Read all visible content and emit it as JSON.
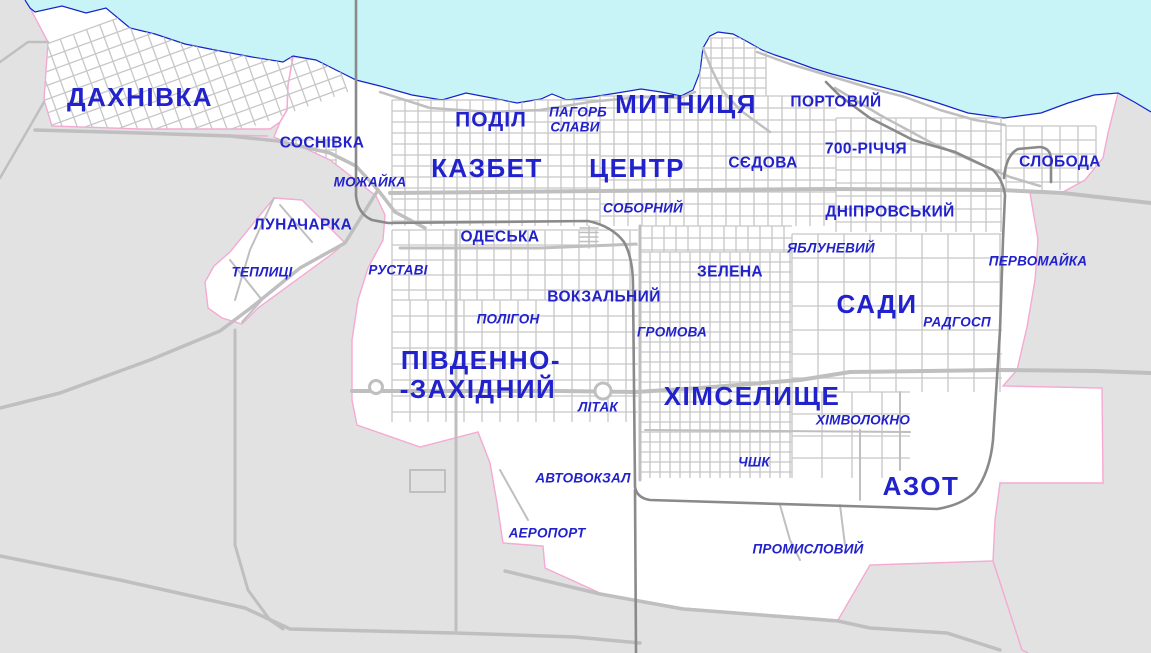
{
  "map": {
    "description": "City district map",
    "labels": [
      {
        "text": "ДАХНІВКА",
        "x": 140,
        "y": 97,
        "style": "xl"
      },
      {
        "text": "МИТНИЦЯ",
        "x": 686,
        "y": 104,
        "style": "xl"
      },
      {
        "text": "КАЗБЕТ",
        "x": 487,
        "y": 168,
        "style": "xl"
      },
      {
        "text": "ЦЕНТР",
        "x": 637,
        "y": 168,
        "style": "xl"
      },
      {
        "text": "ПІВДЕННО-",
        "x": 481,
        "y": 360,
        "style": "xl"
      },
      {
        "text": "-ЗАХІДНИЙ",
        "x": 478,
        "y": 389,
        "style": "xl"
      },
      {
        "text": "ХІМСЕЛИЩЕ",
        "x": 752,
        "y": 396,
        "style": "xl"
      },
      {
        "text": "САДИ",
        "x": 877,
        "y": 304,
        "style": "xl"
      },
      {
        "text": "АЗОТ",
        "x": 921,
        "y": 486,
        "style": "xl"
      },
      {
        "text": "ПОДІЛ",
        "x": 491,
        "y": 120,
        "style": "lg"
      },
      {
        "text": "СОСНІВКА",
        "x": 322,
        "y": 143,
        "style": "md"
      },
      {
        "text": "ЛУНАЧАРКА",
        "x": 303,
        "y": 225,
        "style": "md"
      },
      {
        "text": "ОДЕСЬКА",
        "x": 500,
        "y": 237,
        "style": "md"
      },
      {
        "text": "ВОКЗАЛЬНИЙ",
        "x": 604,
        "y": 297,
        "style": "md"
      },
      {
        "text": "ЗЕЛЕНА",
        "x": 730,
        "y": 272,
        "style": "md"
      },
      {
        "text": "СЄДОВА",
        "x": 763,
        "y": 163,
        "style": "md"
      },
      {
        "text": "ПОРТОВИЙ",
        "x": 836,
        "y": 102,
        "style": "md"
      },
      {
        "text": "700-РІЧЧЯ",
        "x": 866,
        "y": 149,
        "style": "md"
      },
      {
        "text": "ДНІПРОВСЬКИЙ",
        "x": 890,
        "y": 212,
        "style": "md"
      },
      {
        "text": "СЛОБОДА",
        "x": 1060,
        "y": 162,
        "style": "md"
      },
      {
        "text": "МОЖАЙКА",
        "x": 370,
        "y": 182,
        "style": "it"
      },
      {
        "text": "ПАГОРБ",
        "x": 578,
        "y": 112,
        "style": "it"
      },
      {
        "text": "СЛАВИ",
        "x": 575,
        "y": 127,
        "style": "it"
      },
      {
        "text": "СОБОРНИЙ",
        "x": 643,
        "y": 208,
        "style": "it"
      },
      {
        "text": "ЯБЛУНЕВИЙ",
        "x": 831,
        "y": 248,
        "style": "it"
      },
      {
        "text": "ПЕРВОМАЙКА",
        "x": 1038,
        "y": 261,
        "style": "it"
      },
      {
        "text": "ТЕПЛИЦІ",
        "x": 262,
        "y": 272,
        "style": "it"
      },
      {
        "text": "РУСТАВІ",
        "x": 398,
        "y": 270,
        "style": "it"
      },
      {
        "text": "ПОЛІГОН",
        "x": 508,
        "y": 319,
        "style": "it"
      },
      {
        "text": "ГРОМОВА",
        "x": 672,
        "y": 332,
        "style": "it"
      },
      {
        "text": "РАДГОСП",
        "x": 957,
        "y": 322,
        "style": "it"
      },
      {
        "text": "ХІМВОЛОКНО",
        "x": 863,
        "y": 420,
        "style": "it"
      },
      {
        "text": "ЛІТАК",
        "x": 598,
        "y": 407,
        "style": "it"
      },
      {
        "text": "ЧШК",
        "x": 754,
        "y": 462,
        "style": "it"
      },
      {
        "text": "АВТОВОКЗАЛ",
        "x": 583,
        "y": 478,
        "style": "it"
      },
      {
        "text": "АЕРОПОРТ",
        "x": 547,
        "y": 533,
        "style": "it"
      },
      {
        "text": "ПРОМИСЛОВИЙ",
        "x": 808,
        "y": 549,
        "style": "it"
      }
    ],
    "colors": {
      "water": "#C8F4F8",
      "coastline": "#1523C8",
      "outside_land": "#E2E2E2",
      "city_land": "#FFFFFF",
      "city_boundary": "#F5A9D3",
      "road": "#C7C7C7",
      "artery": "#BFBFBF",
      "railway": "#8A8A8A",
      "label_text": "#2222CC"
    }
  }
}
